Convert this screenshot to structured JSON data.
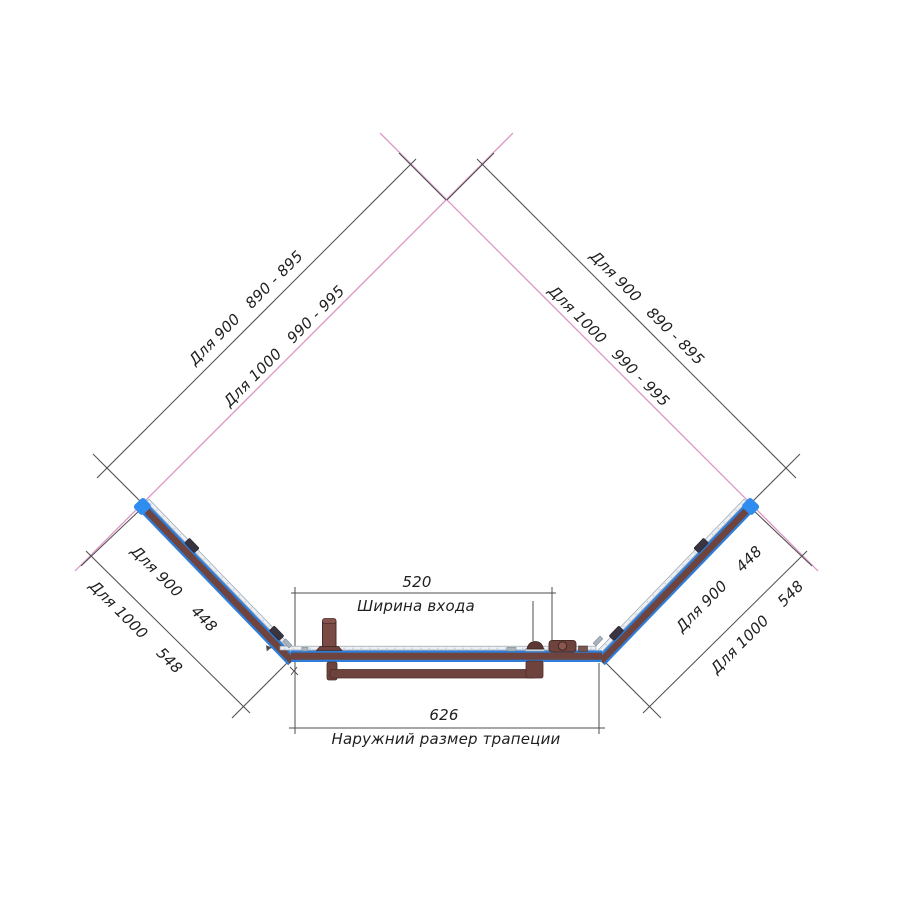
{
  "dimensions": {
    "wall_left": {
      "row1": "Для 900   890 - 895",
      "row2": "Для 1000   990 - 995"
    },
    "wall_right": {
      "row1": "Для 900   890 - 895",
      "row2": "Для 1000   990 - 995"
    },
    "side_left": {
      "row1": "Для 900    448",
      "row2": "Для 1000    548"
    },
    "side_right": {
      "row1": "Для 900    448",
      "row2": "Для 1000    548"
    },
    "entrance": {
      "value": "520",
      "label": "Ширина входа"
    },
    "outer_width": {
      "value": "626",
      "label": "Наружний размер трапеции"
    }
  },
  "colors": {
    "frame_blue": "#2d7dd9",
    "cap_blue": "#2f8df0",
    "profile_brown": "#6f443e",
    "hardware_brown": "#7a4a44",
    "wall_line_pink": "#dc8fc4",
    "dimension_line": "#4d4d4d",
    "text": "#1f1f1f"
  }
}
